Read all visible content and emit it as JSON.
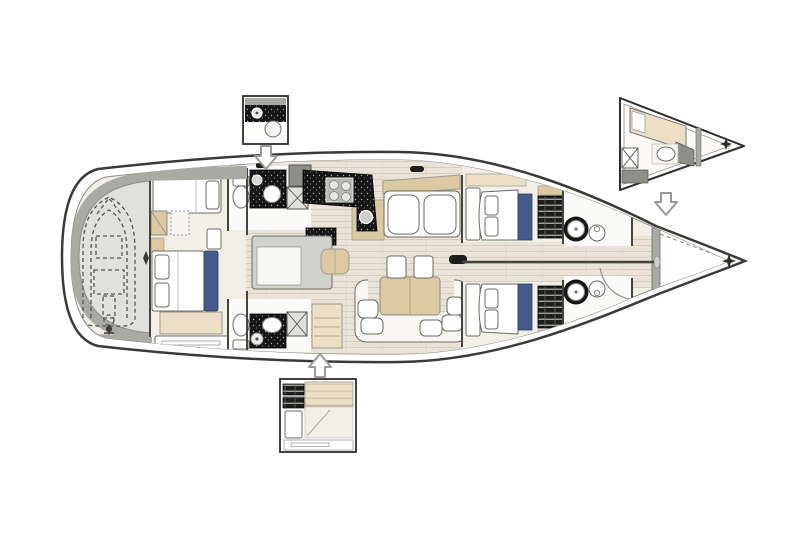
{
  "meta": {
    "title": "Sailing yacht interior layout plan, top view, bow pointing right",
    "view": "top-down deck plan",
    "orientation": "bow-right"
  },
  "colors": {
    "hullOutline": "#3a3a37",
    "wall": "#45453f",
    "strokeSoft": "#6b6b66",
    "deckWhite": "#ffffff",
    "wood": "#e9e4d7",
    "woodLine": "#d7cfbe",
    "cabinFloor": "#f2efe7",
    "headFloor": "#fafaf8",
    "beige": "#dcc9a2",
    "beigeLight": "#ecdfc6",
    "counterBlack": "#161616",
    "accentBlue": "#46598b",
    "grayDark": "#8f8f8a",
    "grayMid": "#aaaaa5",
    "grayLight": "#e0e0dc",
    "islandGray": "#d2d2cd"
  },
  "zones": {
    "garage": {
      "label": "Stern tender garage with inflatable dinghy shown as dashed outline"
    },
    "aftCabin": {
      "label": "Aft owner cabin: double berth with blue headboard, pillows, side berths, bench and sideboard"
    },
    "aftHeadTop": {
      "label": "Aft port head: toilet, black worktop with round basin, hanging locker"
    },
    "aftHeadBottom": {
      "label": "Aft starboard head: toilet, black worktop with oval basin, shower, locker"
    },
    "galley": {
      "label": "Galley: black worktop with four-burner stove and sink, island unit with stool"
    },
    "settee": {
      "label": "Port chaise longue with beige backrest and white cushions"
    },
    "salon": {
      "label": "Saloon: beige dining table, two chairs, U-shaped sofa with scatter cushions"
    },
    "fwdCabinTop": {
      "label": "Forward port guest cabin: double berth with blue runner, shelving unit"
    },
    "fwdCabinBottom": {
      "label": "Forward starboard guest cabin: double berth with blue runner, shelving unit"
    },
    "fwdHeadTop": {
      "label": "Forward port head: round basin and toilet on angled black worktop"
    },
    "fwdHeadBottom": {
      "label": "Forward starboard head: round basin and toilet on angled black worktop"
    },
    "forepeak": {
      "label": "Forepeak sail locker with dashed sole lines and access door arc"
    }
  },
  "insets": {
    "laundry": {
      "label": "Option box: utility area with washer and round basin",
      "arrow": "down"
    },
    "aftOption": {
      "label": "Option box: alternative aft cabin with lockers, berth and shower",
      "arrow": "up"
    },
    "bowOption": {
      "label": "Option box: alternative bow crew cabin with berth, basin and locker",
      "arrow": "down"
    }
  },
  "symbols": {
    "bowStar": "four-point star marker at bow tip",
    "insetStar": "four-point star marker in bow option inset",
    "sternDiamond": "small diamond marker on garage bulkhead"
  }
}
